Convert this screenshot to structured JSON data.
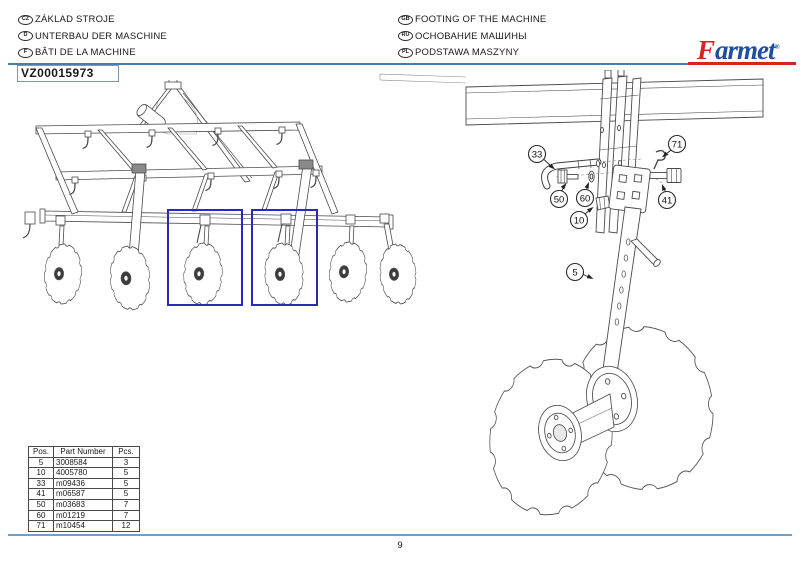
{
  "header": {
    "labels_left": [
      {
        "code": "CZ",
        "text": "ZÁKLAD STROJE"
      },
      {
        "code": "D",
        "text": "UNTERBAU DER MASCHINE"
      },
      {
        "code": "F",
        "text": "BÂTI DE LA MACHINE"
      }
    ],
    "labels_right": [
      {
        "code": "GB",
        "text": "FOOTING OF THE MACHINE"
      },
      {
        "code": "RU",
        "text": "ОСНОВАНИЕ МАШИНЫ"
      },
      {
        "code": "PL",
        "text": "PODSTAWA MASZYNY"
      }
    ],
    "drawing_number": "VZ00015973",
    "logo": {
      "f": "F",
      "rest": "armet",
      "reg": "®"
    }
  },
  "colors": {
    "rule_blue": "#4a7ab0",
    "footer_blue": "#6f9fc4",
    "highlight_box": "#2a2ab8",
    "logo_red": "#d6251f",
    "logo_blue": "#1c4fa0"
  },
  "parts_table": {
    "columns": [
      "Pos.",
      "Part Number",
      "Pcs."
    ],
    "rows": [
      {
        "pos": "5",
        "part": "3008584",
        "pcs": "3"
      },
      {
        "pos": "10",
        "part": "4005780",
        "pcs": "5"
      },
      {
        "pos": "33",
        "part": "m09436",
        "pcs": "5"
      },
      {
        "pos": "41",
        "part": "m06587",
        "pcs": "5"
      },
      {
        "pos": "50",
        "part": "m03683",
        "pcs": "7"
      },
      {
        "pos": "60",
        "part": "m01219",
        "pcs": "7"
      },
      {
        "pos": "71",
        "part": "m10454",
        "pcs": "12"
      }
    ]
  },
  "detail_callouts": [
    {
      "label": "33"
    },
    {
      "label": "50"
    },
    {
      "label": "60"
    },
    {
      "label": "10"
    },
    {
      "label": "71"
    },
    {
      "label": "41"
    },
    {
      "label": "5"
    }
  ],
  "footer": {
    "page": "9"
  }
}
